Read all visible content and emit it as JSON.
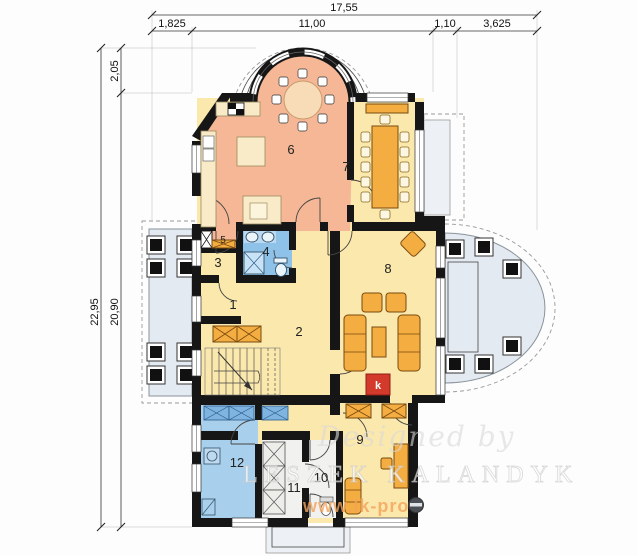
{
  "plan": {
    "dimensions": {
      "top_total": "17,55",
      "top_segments": [
        "1,825",
        "11,00",
        "1,10",
        "3,625"
      ],
      "left_outer": "22,95",
      "left_inner": "20,90",
      "left_top": "2,05"
    },
    "rooms": {
      "r1": "1",
      "r2": "2",
      "r3": "3",
      "r4": "4",
      "r5": "5",
      "r6": "6",
      "r7": "7",
      "r8": "8",
      "r9": "9",
      "r10": "10",
      "r11": "11",
      "r12": "12",
      "fireplace": "k"
    },
    "watermark": {
      "designed_by": "Designed by",
      "author": "LESZEK KALANDYK",
      "website": "www.lk-pro"
    },
    "colors": {
      "wall": "#161616",
      "room_warm": "#F5B795",
      "room_yellow": "#FBE8AC",
      "bathroom_blue": "#8FC2E9",
      "room_blue": "#A8CFEC",
      "furniture_cream": "#FAEBC8",
      "furniture_orange": "#F4AD41",
      "fireplace_red": "#D43A2C",
      "terrace_gray": "#E4EAF1"
    }
  }
}
